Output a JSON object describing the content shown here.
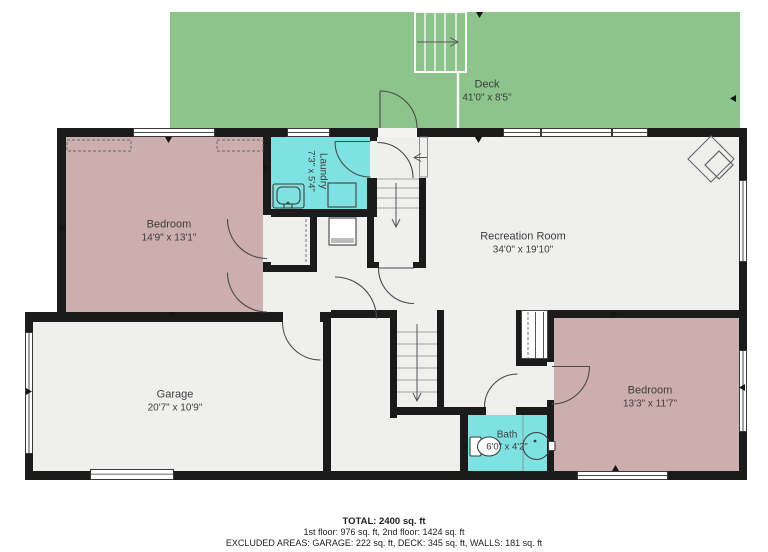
{
  "colors": {
    "deck-green": "#8dc48b",
    "room-pink": "#cdaeae",
    "wet-cyan": "#7fe2e2",
    "floor": "#efefee",
    "wall": "#1b1b1b",
    "line": "#4a4a4a",
    "text": "#3d3d3d"
  },
  "rooms": [
    {
      "id": "deck",
      "name": "Deck",
      "dims": "41'0\" x 8'5\""
    },
    {
      "id": "laundry",
      "name": "Laundry",
      "dims": "7'3\" x 5'4\""
    },
    {
      "id": "bedroom1",
      "name": "Bedroom",
      "dims": "14'9\" x 13'1\""
    },
    {
      "id": "recreation",
      "name": "Recreation Room",
      "dims": "34'0\" x 19'10\""
    },
    {
      "id": "garage",
      "name": "Garage",
      "dims": "20'7\" x 10'9\""
    },
    {
      "id": "bedroom2",
      "name": "Bedroom",
      "dims": "13'3\" x 11'7\""
    },
    {
      "id": "bath",
      "name": "Bath",
      "dims": "6'0\" x 4'2\""
    }
  ],
  "footer": {
    "total": "TOTAL: 2400 sq. ft",
    "floors": "1st floor: 976 sq. ft, 2nd floor: 1424 sq. ft",
    "excluded": "EXCLUDED AREAS: GARAGE: 222 sq. ft, DECK: 345 sq. ft, WALLS: 181 sq. ft"
  }
}
